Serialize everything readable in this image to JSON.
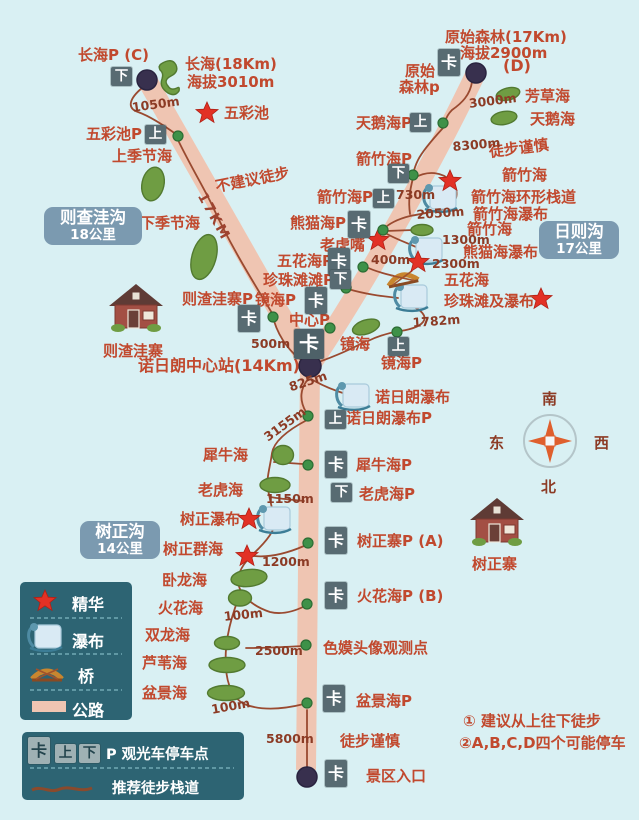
{
  "labels": {
    "changhai_p": "长海P (C)",
    "changhai_info1": "长海(18Km)",
    "changhai_info2": "海拔3010m",
    "wucaichi": "五彩池",
    "wucaichi_p": "五彩池P",
    "shangjijiehai": "上季节海",
    "bujianyi_tubu": "不建议徒步",
    "xiajijiehai": "下季节海",
    "zezhawazhai_p": "则渣洼寨P",
    "zezhawazhai": "则渣洼寨",
    "nuorilang_station": "诺日朗中心站(14Km)",
    "yuanshi_info1": "原始森林(17Km)",
    "yuanshi_info2": "海拔2900m",
    "d_mark": "(D)",
    "yuanshi_p_line1": "原始",
    "yuanshi_p_line2": "森林p",
    "fangcaohai": "芳草海",
    "tianehai_p": "天鹅海P",
    "tianehai": "天鹅海",
    "tubu_jinshen_top": "徒步谨慎",
    "jianzhuhai_p_down": "箭竹海P",
    "jianzhuhai_star": "箭竹海",
    "jianzhuhai_p_up": "箭竹海P",
    "jianzhu_huanxing": "箭竹海环形栈道",
    "jianzhu_pubu": "箭竹海瀑布",
    "xiongmaohai_p": "熊猫海P",
    "jianzhuhai_lake": "箭竹海",
    "laohuzui": "老虎嘴",
    "xiongmaohai_pubu": "熊猫海瀑布",
    "wuhuahai_p": "五花海P",
    "wuhuahai": "五花海",
    "zhenzhutantan_p": "珍珠滩滩P",
    "zhenzhutan_pubu": "珍珠滩及瀑布",
    "jinghai_p_left": "镜海P",
    "zhongxin_p": "中心P",
    "jinghai": "镜海",
    "jinghai_p_right": "镜海P",
    "nuorilang_pubu": "诺日朗瀑布",
    "nuorilang_pubu_p": "诺日朗瀑布P",
    "xiniuhai": "犀牛海",
    "xiniuhai_p": "犀牛海P",
    "laohuhai": "老虎海",
    "laohuhai_p": "老虎海P",
    "shuzheng_pubu": "树正瀑布",
    "shuzhengzhai_p": "树正寨P (A)",
    "shuzhengzhai": "树正寨",
    "shuzheng_qunhai": "树正群海",
    "wolonghai": "卧龙海",
    "huohuahai": "火花海",
    "huohuahai_p": "火花海P (B)",
    "shuanglonghai": "双龙海",
    "luweihai": "芦苇海",
    "semo_viewpoint": "色嫫头像观测点",
    "penjinghai": "盆景海",
    "penjinghai_p": "盆景海P",
    "tubu_jinshen_bottom": "徒步谨慎",
    "jingqu_rukou": "景区入口"
  },
  "distances": {
    "d1050": "1050m",
    "d3000": "3000m",
    "d8300": "8300m",
    "d730": "730m",
    "d2050": "2050m",
    "d1300": "1300m",
    "d400": "400m",
    "d2300": "2300m",
    "d1782": "1782m",
    "d500": "500m",
    "d825": "825m",
    "d3155": "3155m",
    "d1150": "1150m",
    "d1200": "1200m",
    "d100a": "100m",
    "d2500": "2500m",
    "d100b": "100m",
    "d5800": "5800m"
  },
  "road_label": "17KM",
  "badges": {
    "ka": "卡",
    "shang": "上",
    "xia": "下"
  },
  "valleys": {
    "zechawa": {
      "name": "则查洼沟",
      "dist": "18公里"
    },
    "rize": {
      "name": "日则沟",
      "dist": "17公里"
    },
    "shuzheng": {
      "name": "树正沟",
      "dist": "14公里"
    }
  },
  "compass": {
    "n": "北",
    "s": "南",
    "e": "东",
    "w": "西"
  },
  "legend": {
    "star": "精华",
    "waterfall": "瀑布",
    "bridge": "桥",
    "road": "公路",
    "parking": "P 观光车停车点",
    "trail": "推荐徒步栈道"
  },
  "notes": {
    "note1": "① 建议从上往下徒步",
    "note2": "②A,B,C,D四个可能停车"
  }
}
